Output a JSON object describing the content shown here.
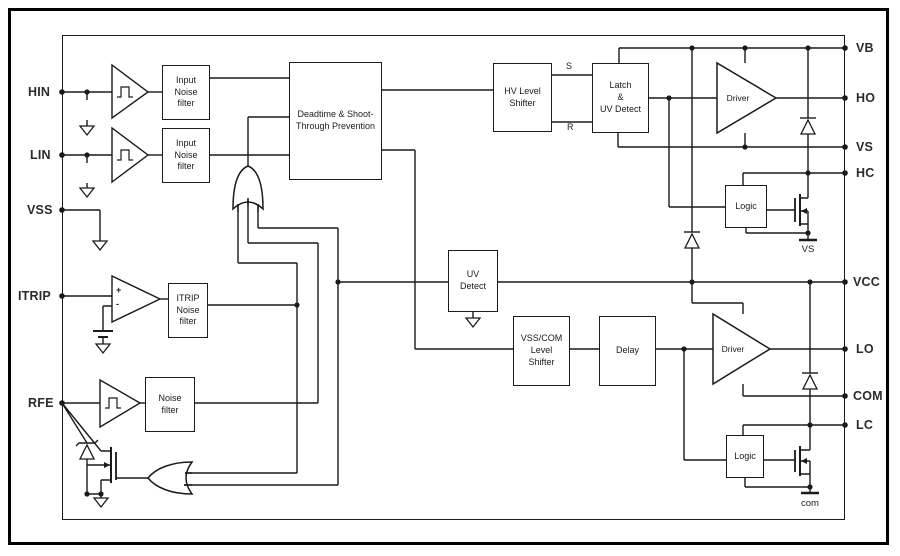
{
  "diagram": {
    "colors": {
      "ink": "#1a1a1a",
      "background": "#ffffff"
    },
    "pins_left": [
      {
        "label": "HIN"
      },
      {
        "label": "LIN"
      },
      {
        "label": "VSS"
      },
      {
        "label": "ITRIP"
      },
      {
        "label": "RFE"
      }
    ],
    "pins_right": [
      {
        "label": "VB"
      },
      {
        "label": "HO"
      },
      {
        "label": "VS"
      },
      {
        "label": "HC"
      },
      {
        "label": "VCC"
      },
      {
        "label": "LO"
      },
      {
        "label": "COM"
      },
      {
        "label": "LC"
      }
    ],
    "blocks": {
      "input_filter_hin": "Input\nNoise\nfilter",
      "input_filter_lin": "Input\nNoise\nfilter",
      "deadtime": "Deadtime & Shoot-\nThrough Prevention",
      "hv_level_shifter": "HV Level\nShifter",
      "latch_uv": "Latch\n&\nUV Detect",
      "uv_detect": "UV\nDetect",
      "vss_com_shifter": "VSS/COM\nLevel\nShifter",
      "delay": "Delay",
      "logic_high": "Logic",
      "logic_low": "Logic",
      "itrip_filter": "ITRIP\nNoise\nfilter",
      "rfe_filter": "Noise\nfilter"
    },
    "labels": {
      "set": "S",
      "reset": "R",
      "driver_high": "Driver",
      "driver_low": "Driver",
      "plus": "+",
      "minus": "-",
      "ground_vs": "VS",
      "ground_com": "com"
    }
  }
}
